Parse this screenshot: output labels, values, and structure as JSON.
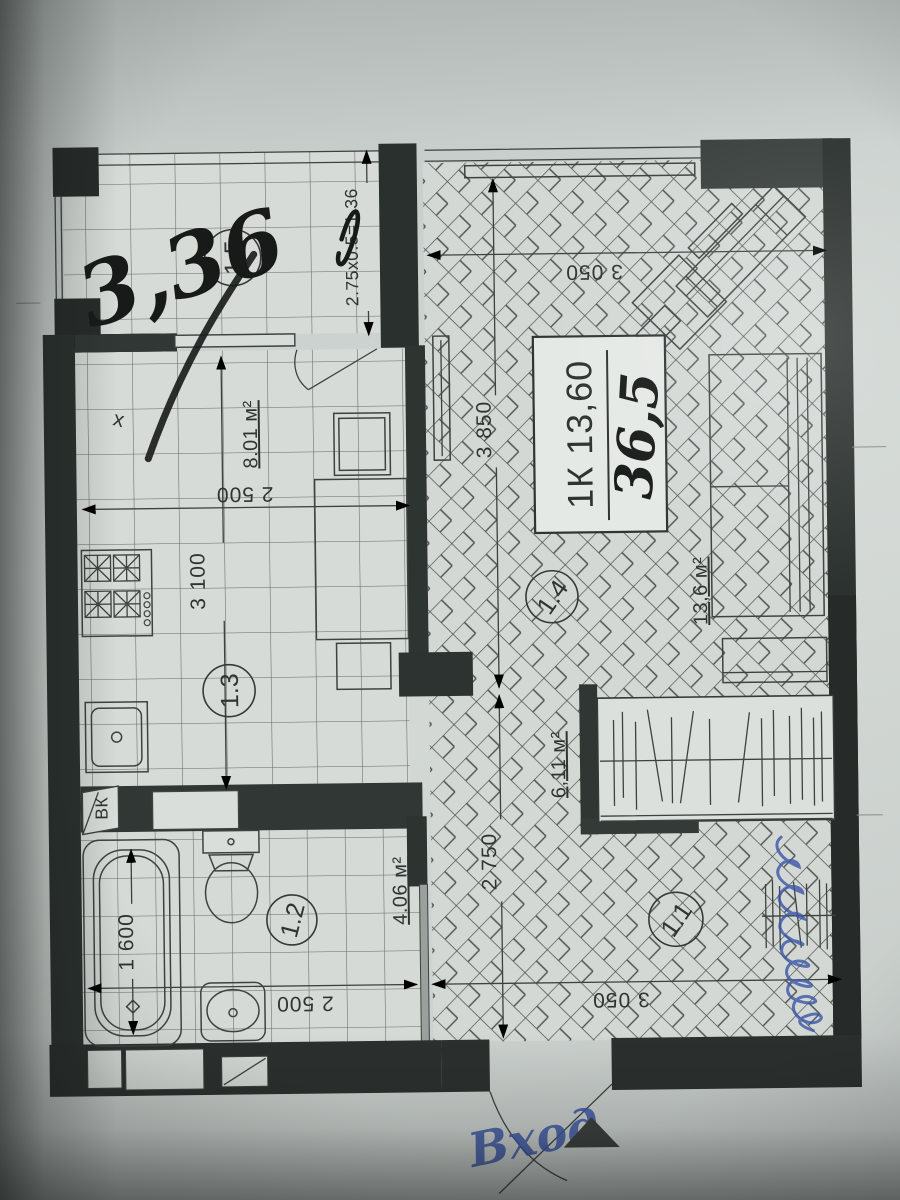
{
  "annotations": {
    "balcony_area": "3,36",
    "total_area": "36,5",
    "entrance": "Вход"
  },
  "unit_box": {
    "label": "1К 13,60"
  },
  "rooms": {
    "balcony": {
      "number": "1.5"
    },
    "living": {
      "number": "1.4",
      "area": "13,6 м²"
    },
    "kitchen": {
      "number": "1.3",
      "area": "8.01 м²"
    },
    "bath": {
      "number": "1.2",
      "area": "4.06 м²"
    },
    "hall": {
      "number": "1.1",
      "area": "6,11 м²"
    }
  },
  "dimensions": {
    "balcony_calc": "2.75x0.5=1.36",
    "living_width": "3 050",
    "living_depth": "3 850",
    "kitchen_width": "2 500",
    "kitchen_depth": "3 100",
    "bath_width": "2 500",
    "hall_width": "3 050",
    "hall_depth": "2 750",
    "tub_length": "1 600"
  },
  "markers": {
    "water_riser": "ВК",
    "cross_mark": "х"
  },
  "colors": {
    "wall": "#2d3331",
    "paper": "#ccd2cf",
    "ink_blue": "#3b55a6"
  }
}
